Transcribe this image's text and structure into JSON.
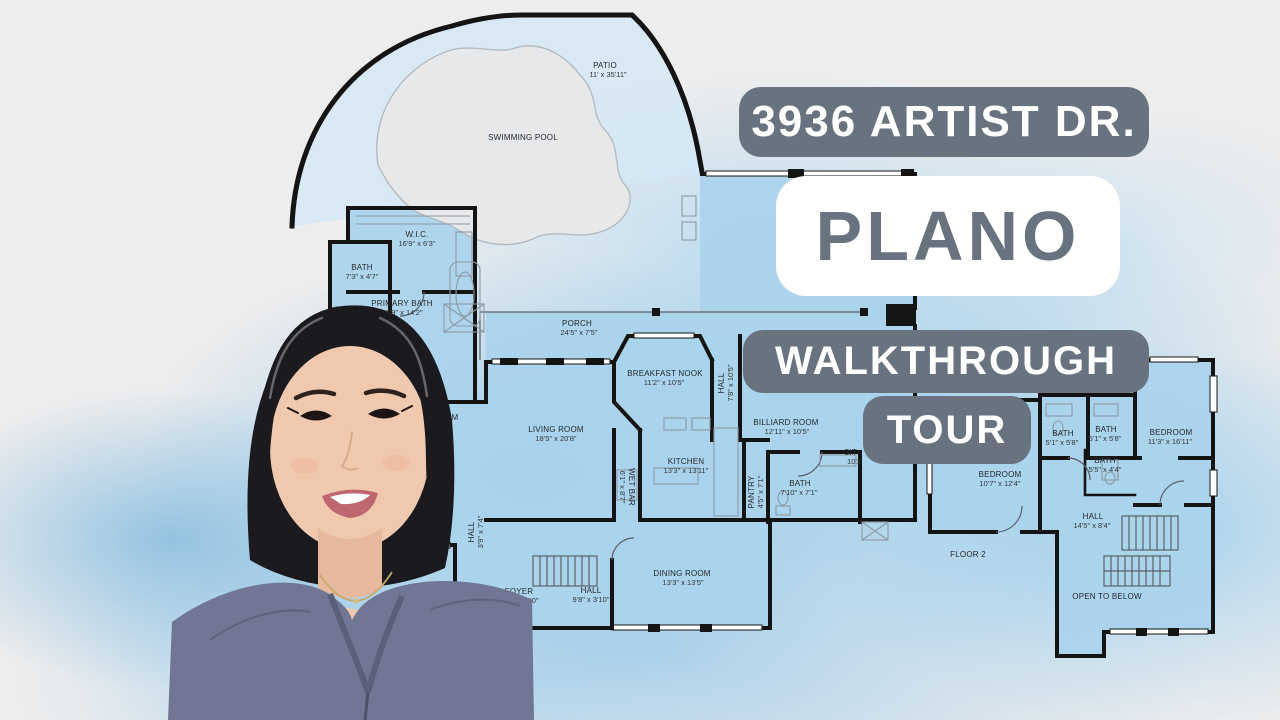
{
  "badges": {
    "address": "3936 ARTIST DR.",
    "city": "PLANO",
    "subtitle_line1": "WALKTHROUGH",
    "subtitle_line2": "TOUR"
  },
  "colors": {
    "badge_gray": "#68737f",
    "badge_text": "#ffffff",
    "plano_bg": "#ffffff",
    "background_gray": "#ededee",
    "watercolor_blue": "#8cc5e8",
    "plan_room_blue": "#a9d3ec",
    "wall_black": "#141414",
    "pool_gray": "#e7e8ea"
  },
  "floor_plan": {
    "floor1": {
      "rooms": [
        {
          "name": "PATIO",
          "dims": "11' x 35'11\""
        },
        {
          "name": "SWIMMING POOL",
          "dims": ""
        },
        {
          "name": "W.I.C.",
          "dims": "16'9\" x 6'3\""
        },
        {
          "name": "BATH",
          "dims": "7'3\" x 4'7\""
        },
        {
          "name": "PRIMARY BATH",
          "dims": "16'9\" x 14'2\""
        },
        {
          "name": "PORCH",
          "dims": "24'5\" x 7'5\""
        },
        {
          "name": "BREAKFAST NOOK",
          "dims": "11'2\" x 10'5\""
        },
        {
          "name": "LIVING ROOM",
          "dims": "18'5\" x 20'8\""
        },
        {
          "name": "KITCHEN",
          "dims": "13'3\" x 13'11\""
        },
        {
          "name": "WET BAR",
          "dims": "6'1\" x 8'7\""
        },
        {
          "name": "HALL",
          "dims": "7'8\" x 10'5\""
        },
        {
          "name": "BILLIARD ROOM",
          "dims": "12'11\" x 10'5\""
        },
        {
          "name": "SIT",
          "dims": "10'2"
        },
        {
          "name": "BATH",
          "dims": "7'10\" x 7'1\""
        },
        {
          "name": "PANTRY",
          "dims": "4'5\" x 7'1\""
        },
        {
          "name": "BEDROOM",
          "dims": ""
        },
        {
          "name": "BATH",
          "dims": "6'5\" x 7'4\""
        },
        {
          "name": "HALL",
          "dims": "3'9\" x 7'4\""
        },
        {
          "name": "FOYER",
          "dims": "8'10\" x 16'0\""
        },
        {
          "name": "HALL",
          "dims": "9'8\" x 3'10\""
        },
        {
          "name": "DINING ROOM",
          "dims": "13'3\" x 13'5\""
        }
      ]
    },
    "floor2": {
      "label": "FLOOR 2",
      "rooms": [
        {
          "name": "BEDROOM",
          "dims": "10'7\" x 12'4\""
        },
        {
          "name": "BATH",
          "dims": "5'1\" x 5'8\""
        },
        {
          "name": "BATH",
          "dims": "5'1\" x 5'8\""
        },
        {
          "name": "BEDROOM",
          "dims": "11'3\" x 16'11\""
        },
        {
          "name": "BATH",
          "dims": "5'5\" x 4'4\""
        },
        {
          "name": "HALL",
          "dims": "14'5\" x 8'4\""
        },
        {
          "name": "OPEN TO BELOW",
          "dims": ""
        }
      ]
    }
  }
}
